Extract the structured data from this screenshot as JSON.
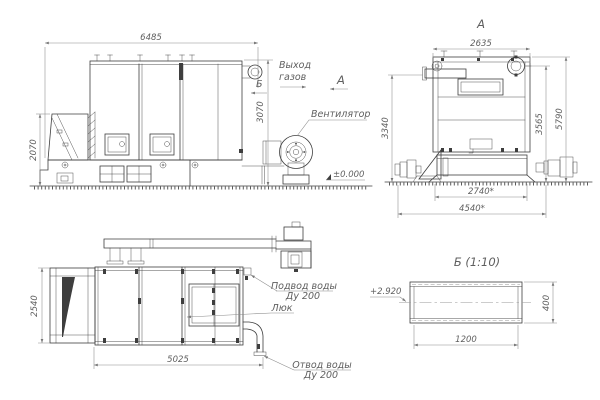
{
  "colors": {
    "background": "#ffffff",
    "line": "#3e3e3e",
    "dim_line": "#8a8a8a",
    "text": "#5f5f5f"
  },
  "views": {
    "side": {
      "dims": {
        "length": "6485",
        "height": "3070",
        "hopper_height": "2070"
      },
      "labels": {
        "gas_outlet": [
          "Выход",
          "газов"
        ],
        "fan": "Вентилятор",
        "ground_level": "±0.000",
        "section_marker": "Б",
        "view_marker": "А"
      }
    },
    "front": {
      "title": "А",
      "dims": {
        "width": "2635",
        "stub_height": "3340",
        "mid_height": "3565",
        "total_height": "5790",
        "base_width": "2740*",
        "overall_width": "4540*"
      }
    },
    "plan": {
      "dims": {
        "width": "2540",
        "length": "5025"
      },
      "labels": {
        "water_supply": [
          "Подвод воды",
          "Ду 200"
        ],
        "hatch": "Люк",
        "water_outlet": [
          "Отвод воды",
          "Ду 200"
        ]
      }
    },
    "section": {
      "title": "Б (1:10)",
      "dims": {
        "length": "1200",
        "height": "400",
        "elevation": "+2.920"
      }
    }
  }
}
